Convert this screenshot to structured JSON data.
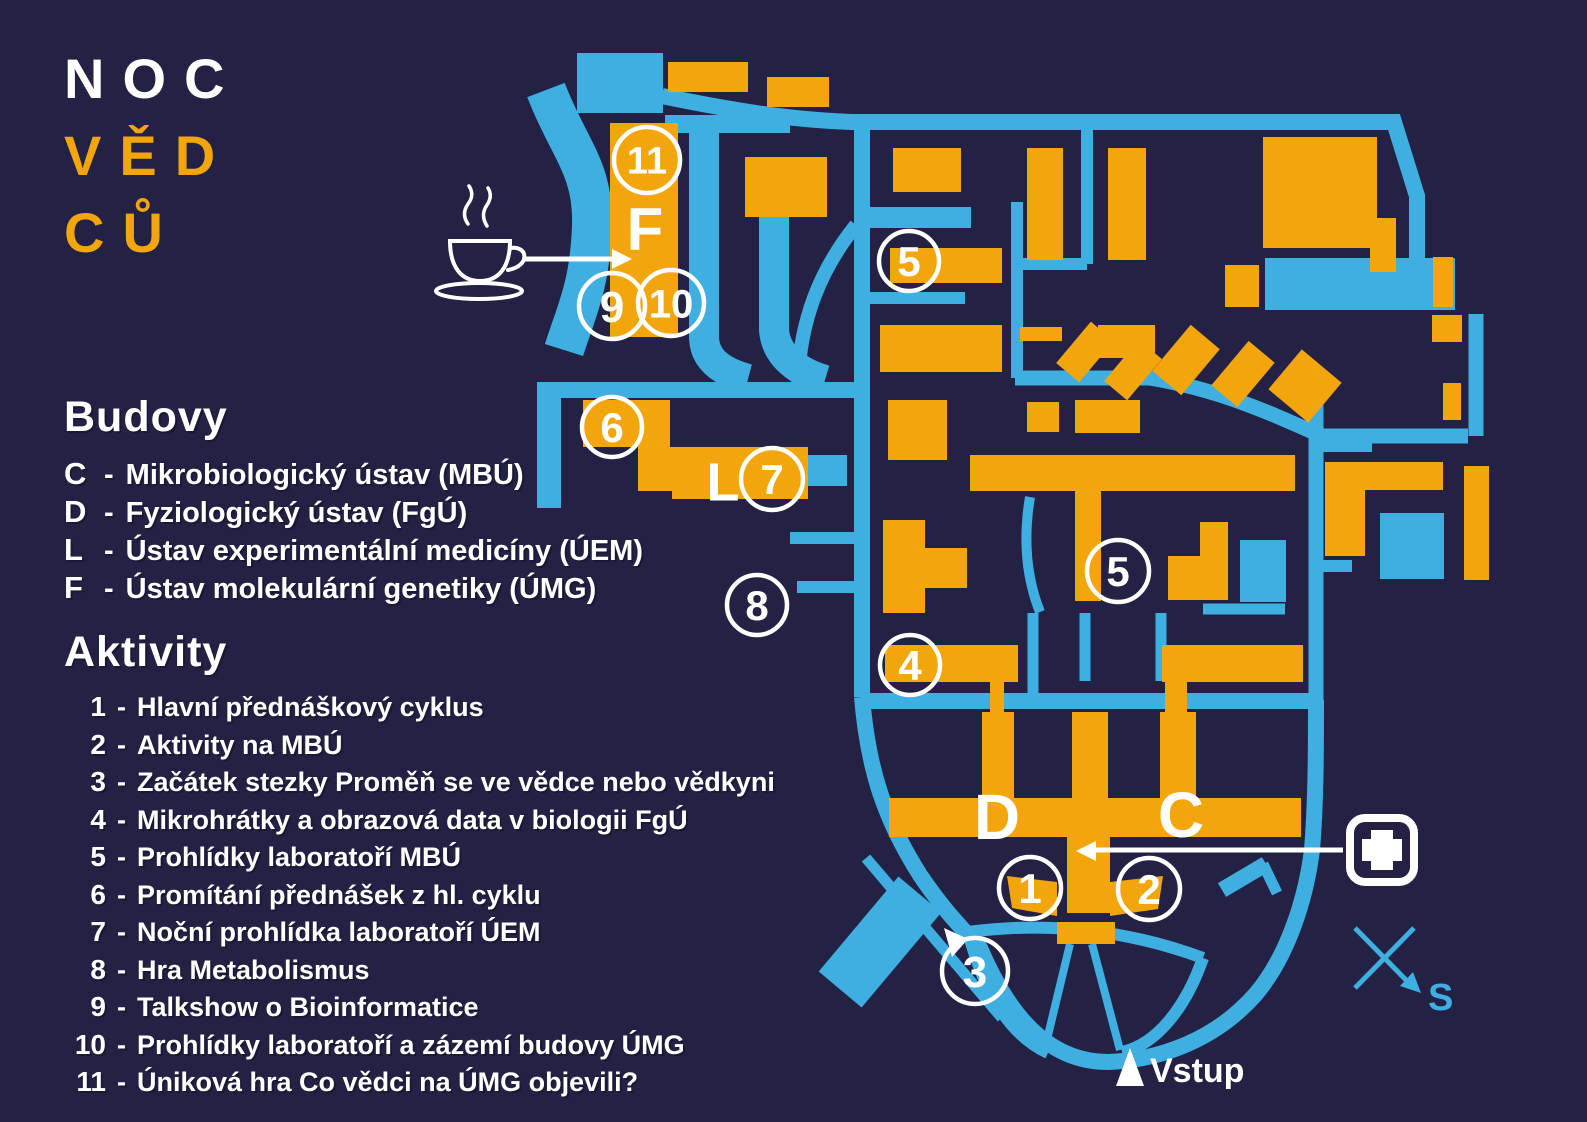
{
  "colors": {
    "background": "#232245",
    "roads": "#3fafe1",
    "buildings": "#f3a50c",
    "text": "#ffffff"
  },
  "logo": {
    "line1": "NOC",
    "line2": "VĚD",
    "line3": "CŮ"
  },
  "legend": {
    "buildings_title": "Budovy",
    "buildings": [
      {
        "key": "C",
        "name": "Mikrobiologický ústav (MBÚ)"
      },
      {
        "key": "D",
        "name": "Fyziologický ústav (FgÚ)"
      },
      {
        "key": "L",
        "name": "Ústav experimentální medicíny (ÚEM)"
      },
      {
        "key": "F",
        "name": "Ústav molekulární genetiky (ÚMG)"
      }
    ],
    "activities_title": "Aktivity",
    "activities": [
      {
        "num": "1",
        "name": "Hlavní přednáškový cyklus"
      },
      {
        "num": "2",
        "name": "Aktivity na MBÚ"
      },
      {
        "num": "3",
        "name": "Začátek stezky Proměň se ve vědce nebo vědkyni"
      },
      {
        "num": "4",
        "name": "Mikrohrátky a obrazová data v biologii FgÚ"
      },
      {
        "num": "5",
        "name": "Prohlídky laboratoří MBÚ"
      },
      {
        "num": "6",
        "name": "Promítání přednášek z hl. cyklu"
      },
      {
        "num": "7",
        "name": "Noční prohlídka laboratoří ÚEM"
      },
      {
        "num": "8",
        "name": "Hra Metabolismus"
      },
      {
        "num": "9",
        "name": "Talkshow o Bioinformatice"
      },
      {
        "num": "10",
        "name": "Prohlídky laboratoří a zázemí budovy ÚMG"
      },
      {
        "num": "11",
        "name": "Úniková hra Co vědci na ÚMG objevili?"
      }
    ]
  },
  "map": {
    "circle_markers": [
      {
        "label": "11",
        "x": 647,
        "y": 160,
        "r": 33,
        "fs": 38
      },
      {
        "label": "9",
        "x": 612,
        "y": 306,
        "r": 33,
        "fs": 44
      },
      {
        "label": "10",
        "x": 671,
        "y": 303,
        "r": 33,
        "fs": 40
      },
      {
        "label": "5",
        "x": 909,
        "y": 261,
        "r": 30,
        "fs": 42
      },
      {
        "label": "6",
        "x": 612,
        "y": 427,
        "r": 30,
        "fs": 42
      },
      {
        "label": "7",
        "x": 772,
        "y": 479,
        "r": 31,
        "fs": 42
      },
      {
        "label": "8",
        "x": 757,
        "y": 605,
        "r": 30,
        "fs": 42
      },
      {
        "label": "4",
        "x": 910,
        "y": 665,
        "r": 30,
        "fs": 42
      },
      {
        "label": "5",
        "x": 1118,
        "y": 571,
        "r": 31,
        "fs": 42
      },
      {
        "label": "1",
        "x": 1030,
        "y": 888,
        "r": 31,
        "fs": 42
      },
      {
        "label": "2",
        "x": 1149,
        "y": 889,
        "r": 31,
        "fs": 42
      },
      {
        "label": "3",
        "x": 975,
        "y": 971,
        "r": 33,
        "fs": 44
      }
    ],
    "building_labels": [
      {
        "label": "F",
        "x": 645,
        "y": 228,
        "size": 60
      },
      {
        "label": "L",
        "x": 723,
        "y": 481,
        "size": 54
      },
      {
        "label": "D",
        "x": 997,
        "y": 816,
        "size": 64
      },
      {
        "label": "C",
        "x": 1181,
        "y": 814,
        "size": 64
      }
    ],
    "entrance_label": "Vstup",
    "compass_label": "S"
  }
}
